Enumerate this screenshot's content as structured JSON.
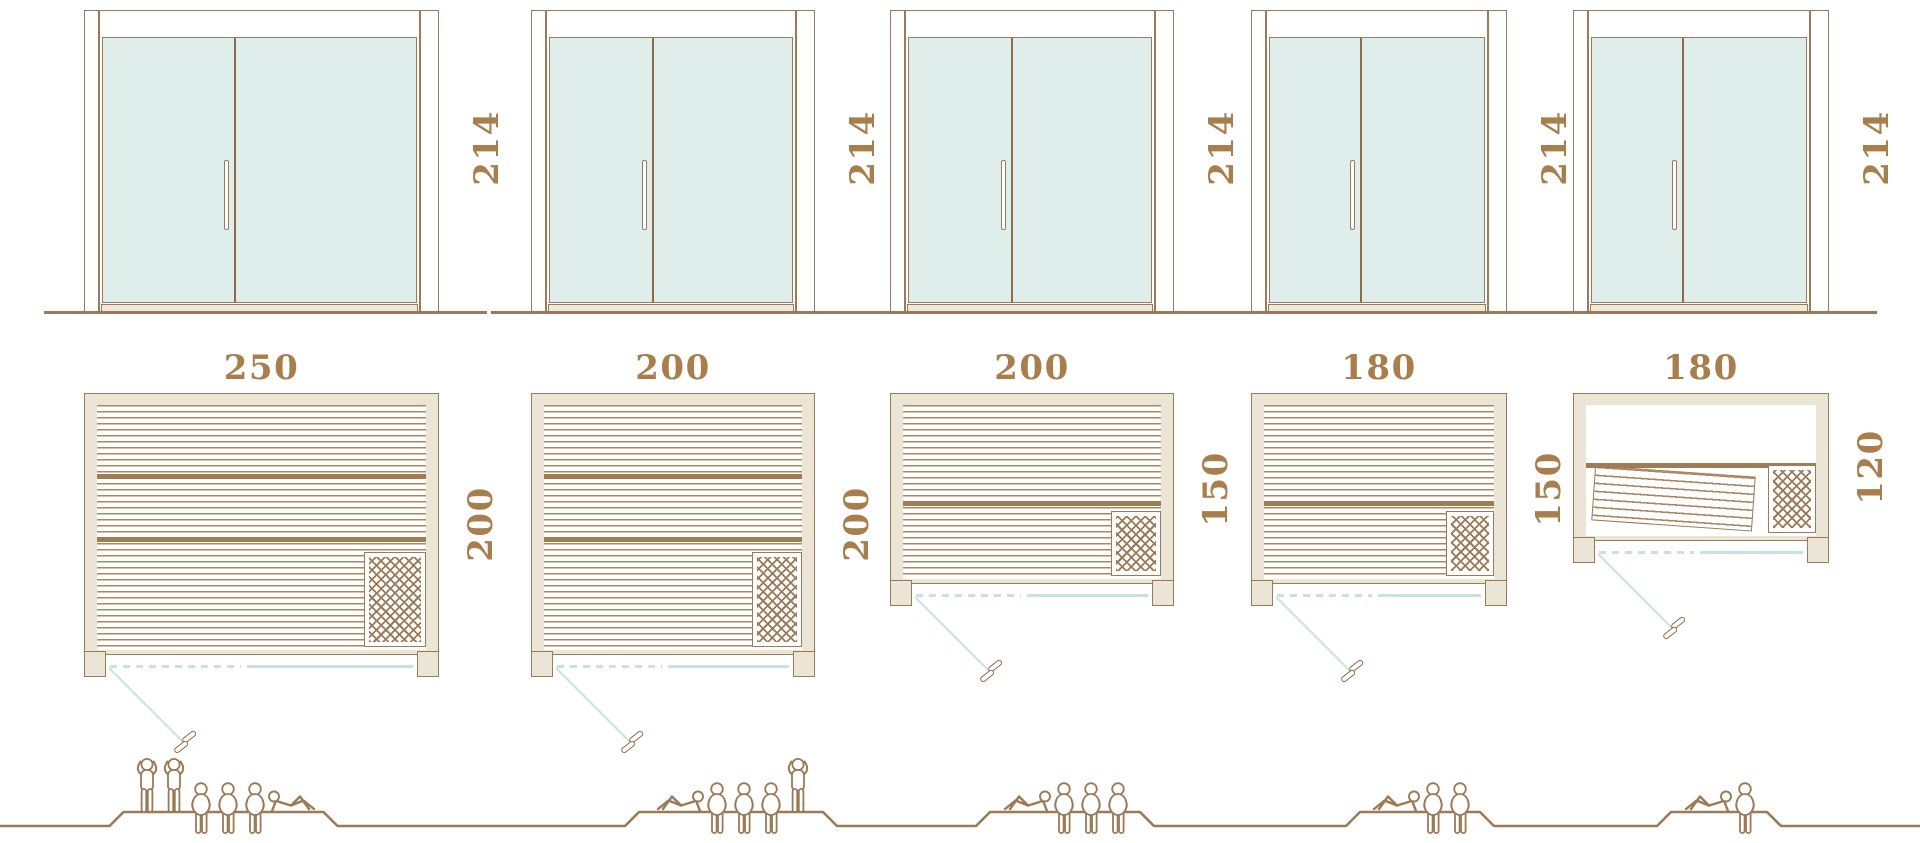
{
  "diagram": {
    "type": "sauna-size-comparison",
    "rows": [
      "door-elevations",
      "floor-plans",
      "capacity-figures"
    ],
    "units": "cm"
  },
  "colors": {
    "outline": "#9a7a57",
    "label_text": "#a87e4d",
    "glass": "#e0eeeb",
    "wood_frame": "#eae5d4",
    "stripe": "#ab8760",
    "band": "#9f7c54",
    "door_swing": "#c8e3df",
    "background": "#ffffff"
  },
  "saunas": [
    {
      "name": "sauna-250x200",
      "height_label": "214",
      "width_label": "250",
      "depth_label": "200",
      "height_cm": 214,
      "width_cm": 250,
      "depth_cm": 200,
      "capacity": 6,
      "people": [
        "standing",
        "standing",
        "sitting",
        "sitting",
        "sitting",
        "lying"
      ],
      "bands": [
        0.28,
        0.54
      ],
      "heater_top": 0.6,
      "tilted_bench": false,
      "people_offset": -38
    },
    {
      "name": "sauna-200x200",
      "height_label": "214",
      "width_label": "200",
      "depth_label": "200",
      "height_cm": 214,
      "width_cm": 200,
      "depth_cm": 200,
      "capacity": 5,
      "people": [
        "lying",
        "sitting",
        "sitting",
        "sitting",
        "standing"
      ],
      "bands": [
        0.28,
        0.54
      ],
      "heater_top": 0.6,
      "tilted_bench": false,
      "people_offset": 58
    },
    {
      "name": "sauna-200x150",
      "height_label": "214",
      "width_label": "200",
      "depth_label": "150",
      "height_cm": 214,
      "width_cm": 200,
      "depth_cm": 150,
      "capacity": 4,
      "people": [
        "lying",
        "sitting",
        "sitting",
        "sitting"
      ],
      "bands": [
        0.55
      ],
      "heater_top": 0.61,
      "tilted_bench": false,
      "people_offset": 33
    },
    {
      "name": "sauna-180x150",
      "height_label": "214",
      "width_label": "180",
      "depth_label": "150",
      "height_cm": 214,
      "width_cm": 180,
      "depth_cm": 150,
      "capacity": 3,
      "people": [
        "lying",
        "sitting",
        "sitting"
      ],
      "bands": [
        0.55
      ],
      "heater_top": 0.61,
      "tilted_bench": false,
      "people_offset": 41
    },
    {
      "name": "sauna-180x120",
      "height_label": "214",
      "width_label": "180",
      "depth_label": "120",
      "height_cm": 214,
      "width_cm": 180,
      "depth_cm": 120,
      "capacity": 2,
      "people": [
        "lying",
        "sitting"
      ],
      "bands": [
        0.44
      ],
      "heater_top": 0.46,
      "tilted_bench": true,
      "people_offset": 18
    }
  ],
  "layout": {
    "canvas": {
      "width": 1920,
      "height": 843
    },
    "px_per_cm": 1.42,
    "column_lefts": [
      84,
      531,
      890,
      1251,
      1573
    ],
    "elevation_top": 10,
    "ground_y": 311,
    "width_label_y": 368,
    "plan_top": 393,
    "people_baseline_y": 826,
    "people_platform_y": 812
  }
}
